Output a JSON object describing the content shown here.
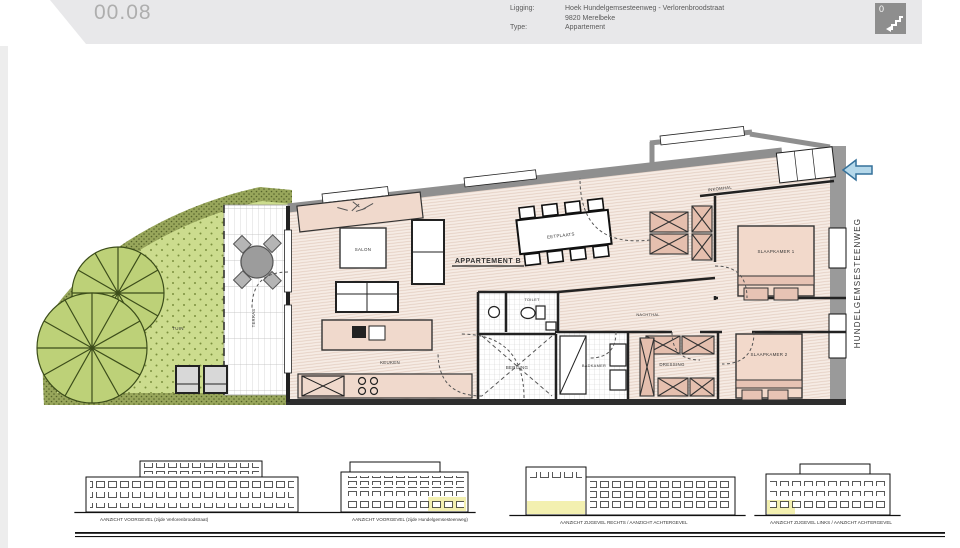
{
  "header": {
    "drawing_number": "00.08",
    "ligging_label": "Ligging:",
    "ligging_line1": "Hoek Hundelgemsesteenweg - Verlorenbroodstraat",
    "ligging_line2": "9820 Merelbeke",
    "type_label": "Type:",
    "type_value": "Appartement",
    "floor_badge": "0"
  },
  "plan": {
    "title": "APPARTEMENT B",
    "street": "HUNDELGEMSESTEENWEG",
    "rooms": {
      "tuin": "TUIN",
      "terras": "TERRAS",
      "salon": "SALON",
      "eetplaats": "EETPLAATS",
      "keuken": "KEUKEN",
      "toilet": "TOILET",
      "berging": "BERGING",
      "badkamer": "BADKAMER",
      "nachthal": "NACHTHAL",
      "dressing": "DRESSING",
      "slaapkamer1": "SLAAPKAMER 1",
      "slaapkamer2": "SLAAPKAMER 2",
      "inkomhal": "INKOMHAL"
    }
  },
  "elevations": {
    "captions": [
      "AANZICHT VOORGEVEL (zijde Verlorenbroodstraat)",
      "AANZICHT VOORGEVEL (zijde Hundelgemsesteenweg)",
      "AANZICHT ZIJGEVEL RECHTS / AANZICHT ACHTERGEVEL",
      "AANZICHT ZIJGEVEL LINKS / AANZICHT ACHTERGEVEL"
    ]
  },
  "colors": {
    "garden_band": "#98a65b",
    "garden_fill": "#ccdc8e",
    "wall_gray": "#8f8f8f",
    "furniture_pink": "#f0d9cc",
    "hatch_pink": "#e5bfae",
    "arrow_blue": "#b5d8ea",
    "highlight_yellow": "#f3f0b0",
    "street_text": "#6e7b3c"
  }
}
